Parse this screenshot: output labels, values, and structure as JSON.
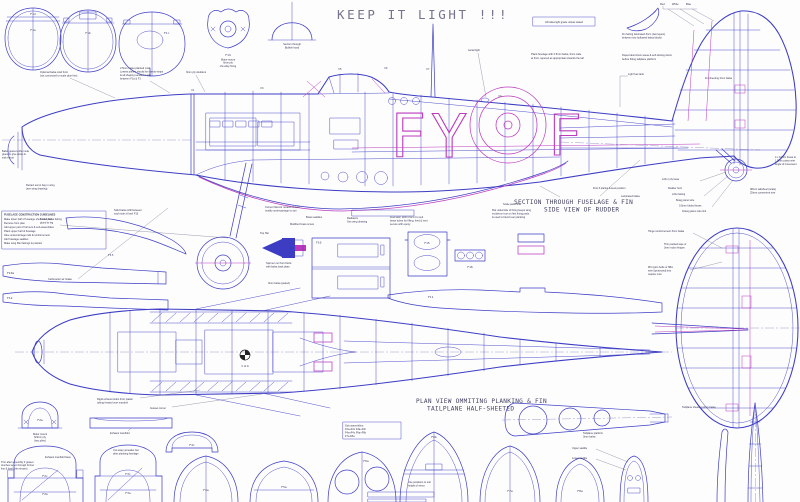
{
  "title": "KEEP IT LIGHT !!!",
  "colors": {
    "line": "#3d3dc4",
    "accent": "#bd3abd",
    "text": "#32324e",
    "title": "#74748c"
  },
  "material_note": "All balsa light grade unless stated",
  "markings": {
    "code": "FY",
    "tail": "F"
  },
  "flash": {
    "red": "Red",
    "white": "White",
    "blue": "Blue"
  },
  "sec": {
    "fuselage_fin": "SECTION THROUGH FUSELAGE & FIN",
    "rudder": "SIDE VIEW OF RUDDER",
    "plan_view": "PLAN VIEW OMMITING PLANKING & FIN",
    "tailplane": "TAILPLANE HALF-SHEETED",
    "hood1": "Section through",
    "hood2": "Bubble hood"
  },
  "formers": {
    "f1a": "F1a",
    "f1b": "F1b",
    "f1c": "F1c",
    "f1d": "F1d",
    "f14": "F14",
    "f13": "F13",
    "f10a": "F10a",
    "f12": "F12",
    "f10": "F10",
    "f15": "F15",
    "f16": "F16",
    "f11": "F11",
    "f2a": "F2a",
    "f2c": "F2c",
    "f3a": "F3a",
    "f3c": "F3c",
    "f4a": "F4a",
    "f4c": "F4c",
    "f5a": "F5a",
    "f6a": "F6a",
    "f6b": "F6b",
    "f7a": "F7a",
    "f8a": "F8a"
  },
  "stations": {
    "s1": "F1",
    "s3": "F3",
    "s5": "F5",
    "s6": "F6",
    "s7": "F7",
    "s9": "F9"
  },
  "guidelines": {
    "title": "FUSELAGE CONSTRUCTION GUIDELINES",
    "l1": "Make lower half of fuselage shell over plan",
    "l2": "Remove from plan",
    "l3": "Add upper part of formers & sub-assemblies",
    "l4": "Plank upper half of fuselage",
    "l5": "Glue undercarriage rails & reinforcement",
    "l6": "Add fuselage saddles",
    "l7": "Make wing fillet fairings & position"
  },
  "sub": {
    "l1": "Sub assemblies:",
    "l2": "F2a+F2c  F3a+F3c",
    "l3": "F4a+F4c  F6a+F6b",
    "l4": "F7a  F8a"
  },
  "ann": {
    "cowl1": "Optional balsa cowl front",
    "cowl2": "(not connected to scale glue line)",
    "plank1": "2.5mm balsa planked cowl.",
    "plank2": "Lowest planks should be narrow strips",
    "plank3": "& all shaping sanded in situ",
    "plank4": "between F1a & F1",
    "ply": "3mm ply doublers",
    "aerial": "Aerial light",
    "fuse_plank1": "Plank fuselage with 2.5mm balsa, 9mm wide",
    "fuse_plank2": "at front, tapered as appropriate towards the tail",
    "light_tank": "Light fuel tank",
    "fairing1": "Fin fairing laminated 3mm (two layers)",
    "fairing2": "between two hollowed balsa blocks",
    "doped1": "Doped aluminium areas & self-closing doors",
    "doped2": "before fitting tailplane platform",
    "fin_sheet": "Fin sheeting 2mm balsa",
    "first_planks": "First 3 planks & keel position",
    "laminated": "Laminated balsa",
    "scale1": "Scale panel line",
    "flat1": "Flat underside of fixing keeps wing",
    "flat2": "incidence true on first fixing pads",
    "flat3": "& used to blend rear planking",
    "fuel1": "Fuel tank: drill F3 & F4 to suit",
    "fuel2": "brass tubes for filling, feed & vent",
    "fuel3": "secure with epoxy",
    "rad1": "Radiators",
    "rad2": "See wing drawing",
    "saddles": "Brass saddles",
    "screw": "Modified brass screw",
    "retracts1": "Current Mel-Air retracts shown",
    "retracts2": "modify undercarriage to suit",
    "infill1": "Solid balsa infill between",
    "infill2": "each side of keel F13",
    "coiled1": "Coiled balsa fairing",
    "coiled2": "glued to leg",
    "carb": "Carburettor air intake",
    "gusset_nose1": "Balsa gusset either side",
    "gusset_nose2": "glued to give down &",
    "gusset_nose3": "side thrust",
    "retract_bay1": "Retract servo bay in wing",
    "retract_bay2": "(see wing drawing)",
    "hinge_reinf": "Hinge reinforcement 3mm balsa",
    "hinges1": "Thin packed tape or",
    "hinges2": "3mm nylon hinges",
    "bolts1": "M3 nylon bolts or 6BA",
    "bolts2": "steel (protected) into",
    "bolts3": "captive nuts",
    "tail_sheet": "Tailplane sheeting 2mm balsa",
    "platform1": "Tailplane platform",
    "platform2": "3mm balsa",
    "upper_saddle": "Upper saddle",
    "lower_saddle": "Lower saddle",
    "litho_base": "Litho / ply base",
    "rudder_horn": "Rudder horn",
    "litho_fairing": "Litho fairing",
    "piano_wire": "8swg piano wire",
    "folded_brass": "0.5mm folded brass",
    "wire_link": "16swg piano wire link",
    "tailwheel1": "38mm tailwheel (scale)",
    "tailwheel2": "25mm convenient size",
    "brass1": "4 x 10mm brass to",
    "brass2": "1.5mm piano wire",
    "brass3": "angle of movement",
    "exh_stubs1": "Rigid exhaust stubs from plastic",
    "exh_stubs2": "tubing heated over mandrel",
    "exh_manifold": "Exhaust manifold",
    "manifold_base": "Exhaust manifold base",
    "gusset": "Gusset corner",
    "spreader1": "Cut away spreader bar",
    "spreader2": "after planking fuselage",
    "mm14_1": "Motor mount",
    "mm14_2": "6mm ply",
    "mm14_3": "c/w alloy fixing",
    "mm2a_1": "Motor mount",
    "mm2a_2": "6/4mm ply",
    "mm2a_3": "(two plies)",
    "tophat": "Top Hat",
    "spin1": "Spinner cut from block",
    "spin2": "with balsa back plate",
    "paired": "3mm balsa (paired)",
    "servo1": "Use positions to suit",
    "servo2": "height of servo",
    "trim1": "Trim after assembly if gusset",
    "trim2": "touches servo through former",
    "trim3": "line & keel (trim shown)",
    "cg": "C of G"
  }
}
